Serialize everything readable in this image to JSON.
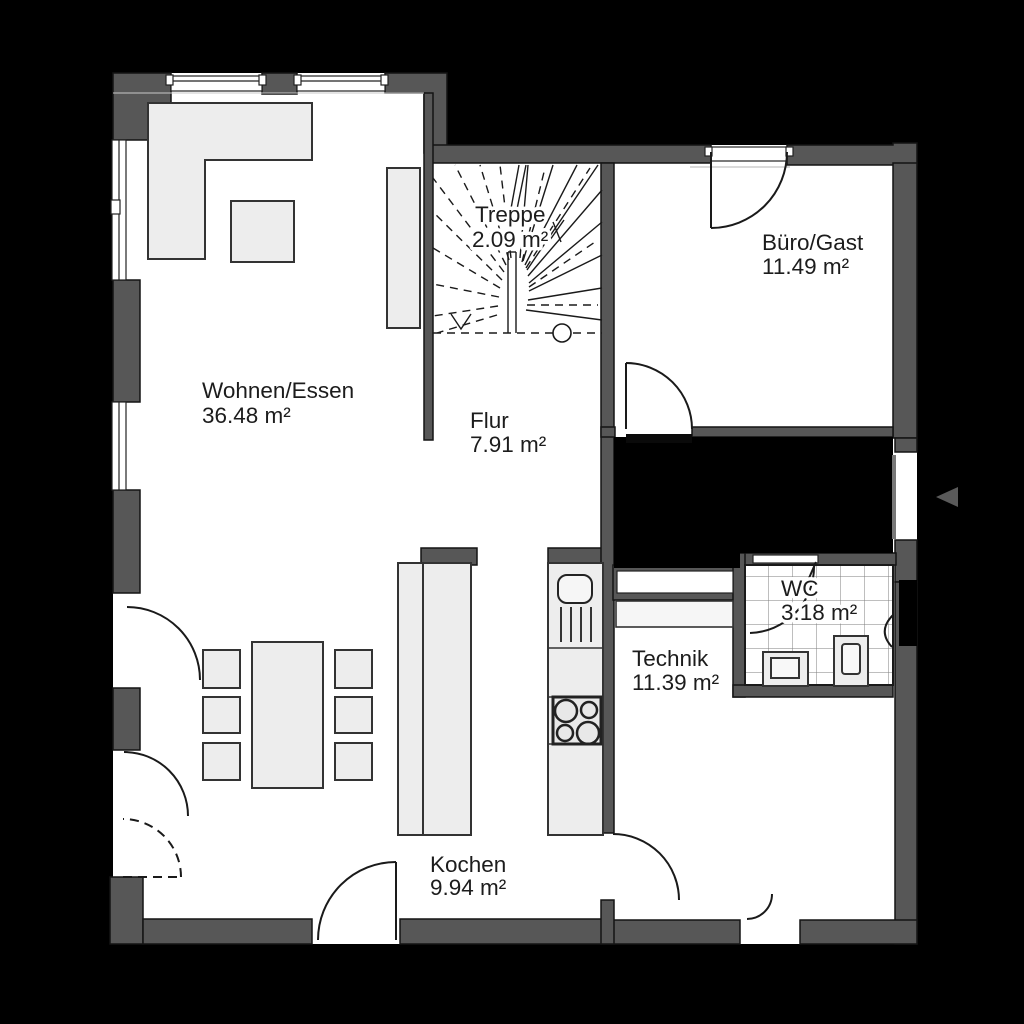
{
  "plan": {
    "title": "Erdgeschoss Grundriss",
    "rooms": {
      "wohnen": {
        "name": "Wohnen/Essen",
        "area": "36.48 m²"
      },
      "treppe": {
        "name": "Treppe",
        "area": "2.09 m²"
      },
      "flur": {
        "name": "Flur",
        "area": "7.91 m²"
      },
      "buero": {
        "name": "Büro/Gast",
        "area": "11.49 m²"
      },
      "wc": {
        "name": "WC",
        "area": "3.18 m²"
      },
      "technik": {
        "name": "Technik",
        "area": "11.39 m²"
      },
      "kochen": {
        "name": "Kochen",
        "area": "9.94 m²"
      }
    },
    "icons": {
      "entrance_arrow": "entrance-direction-arrow"
    },
    "colors": {
      "background": "#000000",
      "wall": "#575757",
      "floor": "#ffffff",
      "furniture": "#ededed",
      "line": "#1a1a1a",
      "arrow": "#5a5a5a"
    }
  }
}
